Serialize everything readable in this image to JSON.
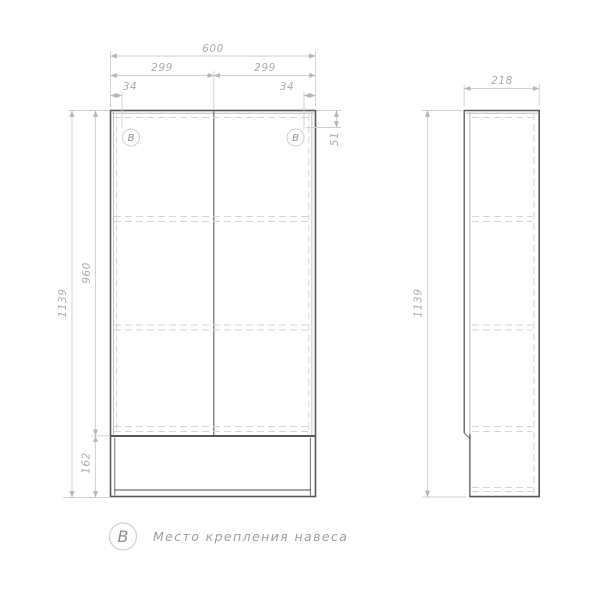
{
  "drawing": {
    "front_view": {
      "width_total": "600",
      "door_width_left": "299",
      "door_width_right": "299",
      "mount_offset_left": "34",
      "mount_offset_right": "34",
      "mount_depth": "51",
      "door_height": "960",
      "height_total": "1139",
      "base_height": "162",
      "mount_marker_left": "В",
      "mount_marker_right": "В"
    },
    "side_view": {
      "depth": "218",
      "height_total": "1139"
    },
    "legend": {
      "symbol": "В",
      "label": "Место крепления навеса"
    },
    "colors": {
      "outline": "#54585a",
      "thin_line": "#cdd0d2",
      "dashed_line": "#d2d5d7",
      "dimension_text": "#a8adb0",
      "marker_text": "#8b8f92",
      "background": "#ffffff"
    }
  }
}
